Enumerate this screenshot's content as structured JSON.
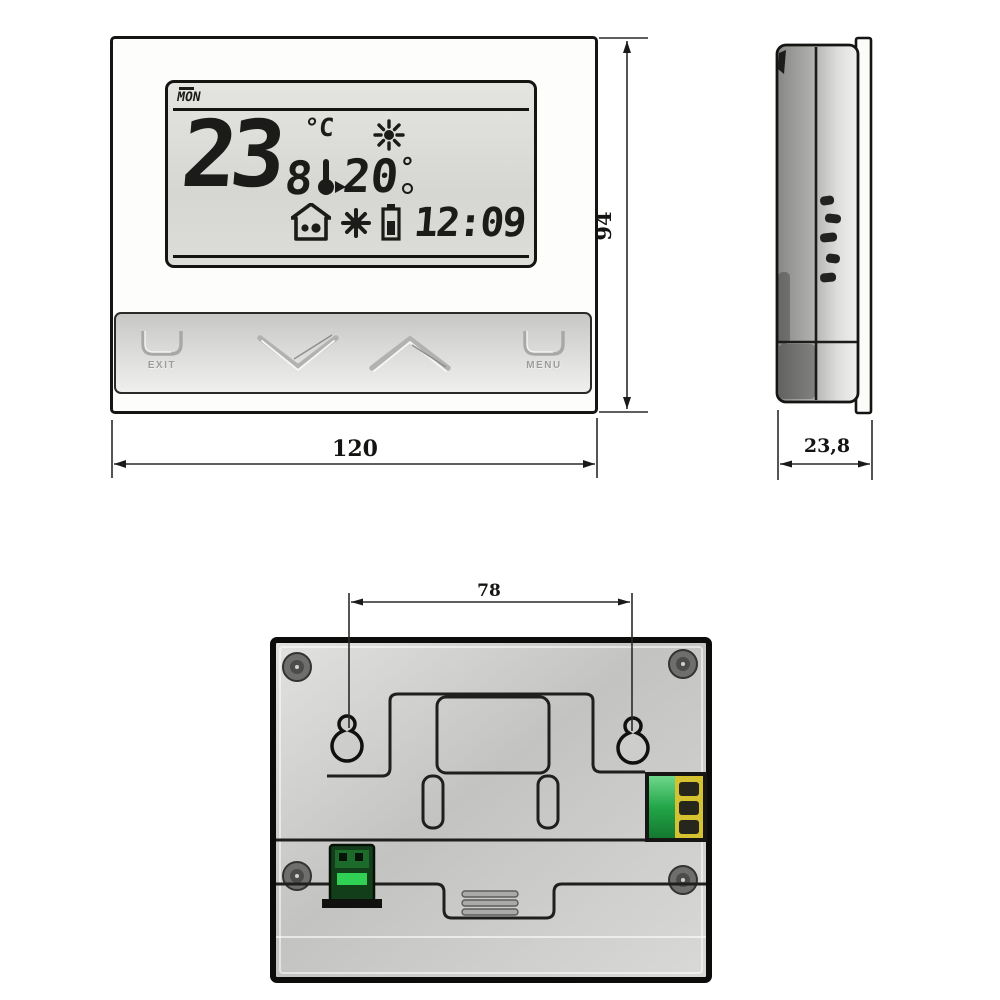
{
  "drawing": {
    "kind": "thermostat dimensional drawing",
    "views": [
      "front",
      "side",
      "back"
    ]
  },
  "front_view": {
    "lcd": {
      "day": "MON",
      "temperature": "23",
      "temperature_unit": "°C",
      "program_digit": "8",
      "setpoint_temperature": "20",
      "setpoint_unit": "°",
      "time": "12:09",
      "icons": {
        "sun_large": "sun-icon",
        "thermometer": "thermometer-arrow-icon",
        "house": "house-icon",
        "sun_small": "sun-burst-icon",
        "battery": "battery-icon"
      }
    },
    "buttons": {
      "exit": "EXIT",
      "menu": "MENU",
      "down": "chevron-down-icon",
      "up": "chevron-up-icon"
    }
  },
  "dimensions": {
    "width_mm": "120",
    "height_mm": "94",
    "depth_mm": "23,8",
    "mounting_distance_mm": "78"
  },
  "colors": {
    "outline": "#141412",
    "lcd_background": "#dadad6",
    "button_bar_silver": "#d8d8d6",
    "terminal_green": "#23a649",
    "terminal_yellow": "#d4c231",
    "connector_green": "#2fd054",
    "back_panel_silver": "#cccccb"
  }
}
